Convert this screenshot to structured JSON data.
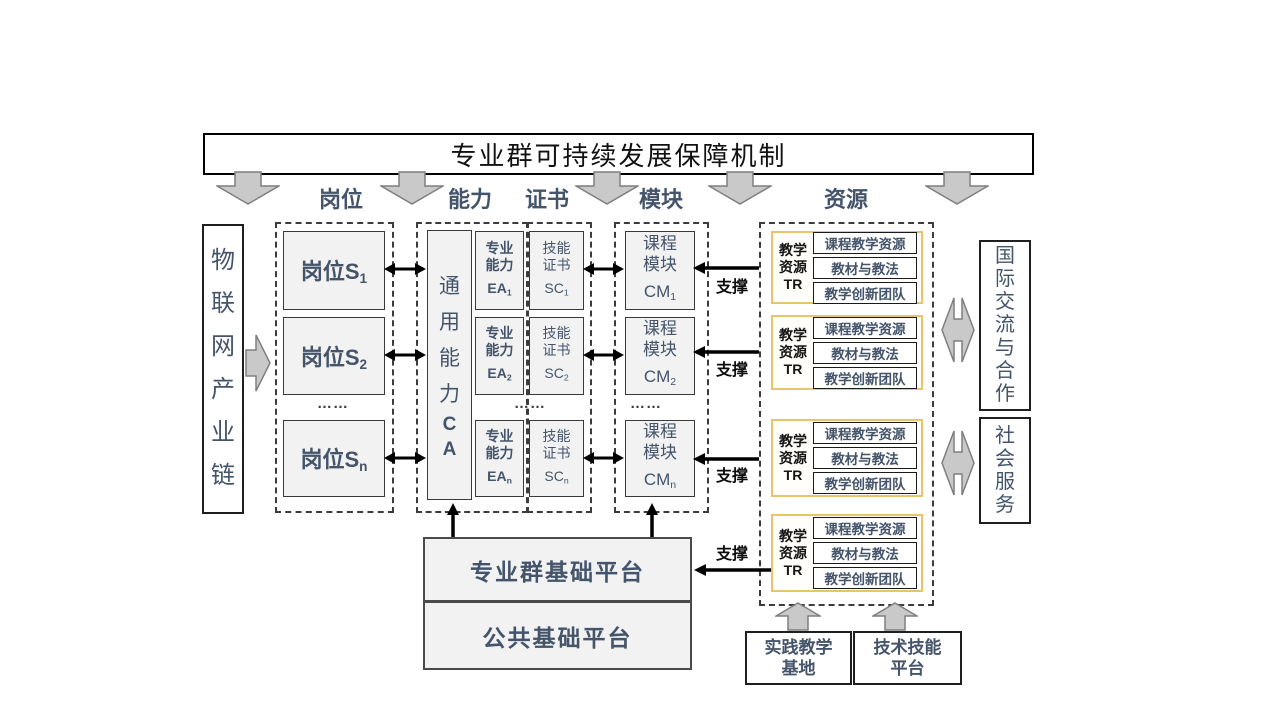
{
  "banner": {
    "title": "专业群可持续发展保障机制"
  },
  "headers": {
    "positions": "岗位",
    "ability": "能力",
    "certificate": "证书",
    "module": "模块",
    "resource": "资源"
  },
  "industry_chain": {
    "label": "物联网产业链"
  },
  "positions": {
    "rows": [
      {
        "text": "岗位S",
        "sub": "1"
      },
      {
        "text": "岗位S",
        "sub": "2"
      },
      {
        "text": "岗位S",
        "sub": "n"
      }
    ]
  },
  "dots": "……",
  "general_ability": {
    "cn": "通用能力",
    "en": "CA"
  },
  "rows": [
    {
      "ea1": "专业",
      "ea2": "能力",
      "ea_base": "EA",
      "ea_sub": "1",
      "sc1": "技能",
      "sc2": "证书",
      "sc_base": "SC",
      "sc_sub": "1",
      "cm1": "课程",
      "cm2": "模块",
      "cm_base": "CM",
      "cm_sub": "1"
    },
    {
      "ea1": "专业",
      "ea2": "能力",
      "ea_base": "EA",
      "ea_sub": "2",
      "sc1": "技能",
      "sc2": "证书",
      "sc_base": "SC",
      "sc_sub": "2",
      "cm1": "课程",
      "cm2": "模块",
      "cm_base": "CM",
      "cm_sub": "2"
    },
    {
      "ea1": "专业",
      "ea2": "能力",
      "ea_base": "EA",
      "ea_sub": "n",
      "sc1": "技能",
      "sc2": "证书",
      "sc_base": "SC",
      "sc_sub": "n",
      "cm1": "课程",
      "cm2": "模块",
      "cm_base": "CM",
      "cm_sub": "n"
    }
  ],
  "resources": {
    "label1": "教学",
    "label2": "资源",
    "label3": "TR",
    "item1": "课程教学资源",
    "item2": "教材与教法",
    "item3": "教学创新团队"
  },
  "support_label": "支撑",
  "platforms": {
    "group": "专业群基础平台",
    "common": "公共基础平台"
  },
  "foundations": {
    "practice_l1": "实践教学",
    "practice_l2": "基地",
    "tech_l1": "技术技能",
    "tech_l2": "平台"
  },
  "services": {
    "international": "国际交流与合作",
    "social": "社会服务"
  },
  "colors": {
    "text_blue": "#44546A",
    "gold_border": "#E9C46A",
    "box_fill": "#F2F2F2",
    "arrow_gray_fill": "#C9C9C9",
    "arrow_gray_border": "#7F7F7F",
    "connector_black": "#000000"
  }
}
